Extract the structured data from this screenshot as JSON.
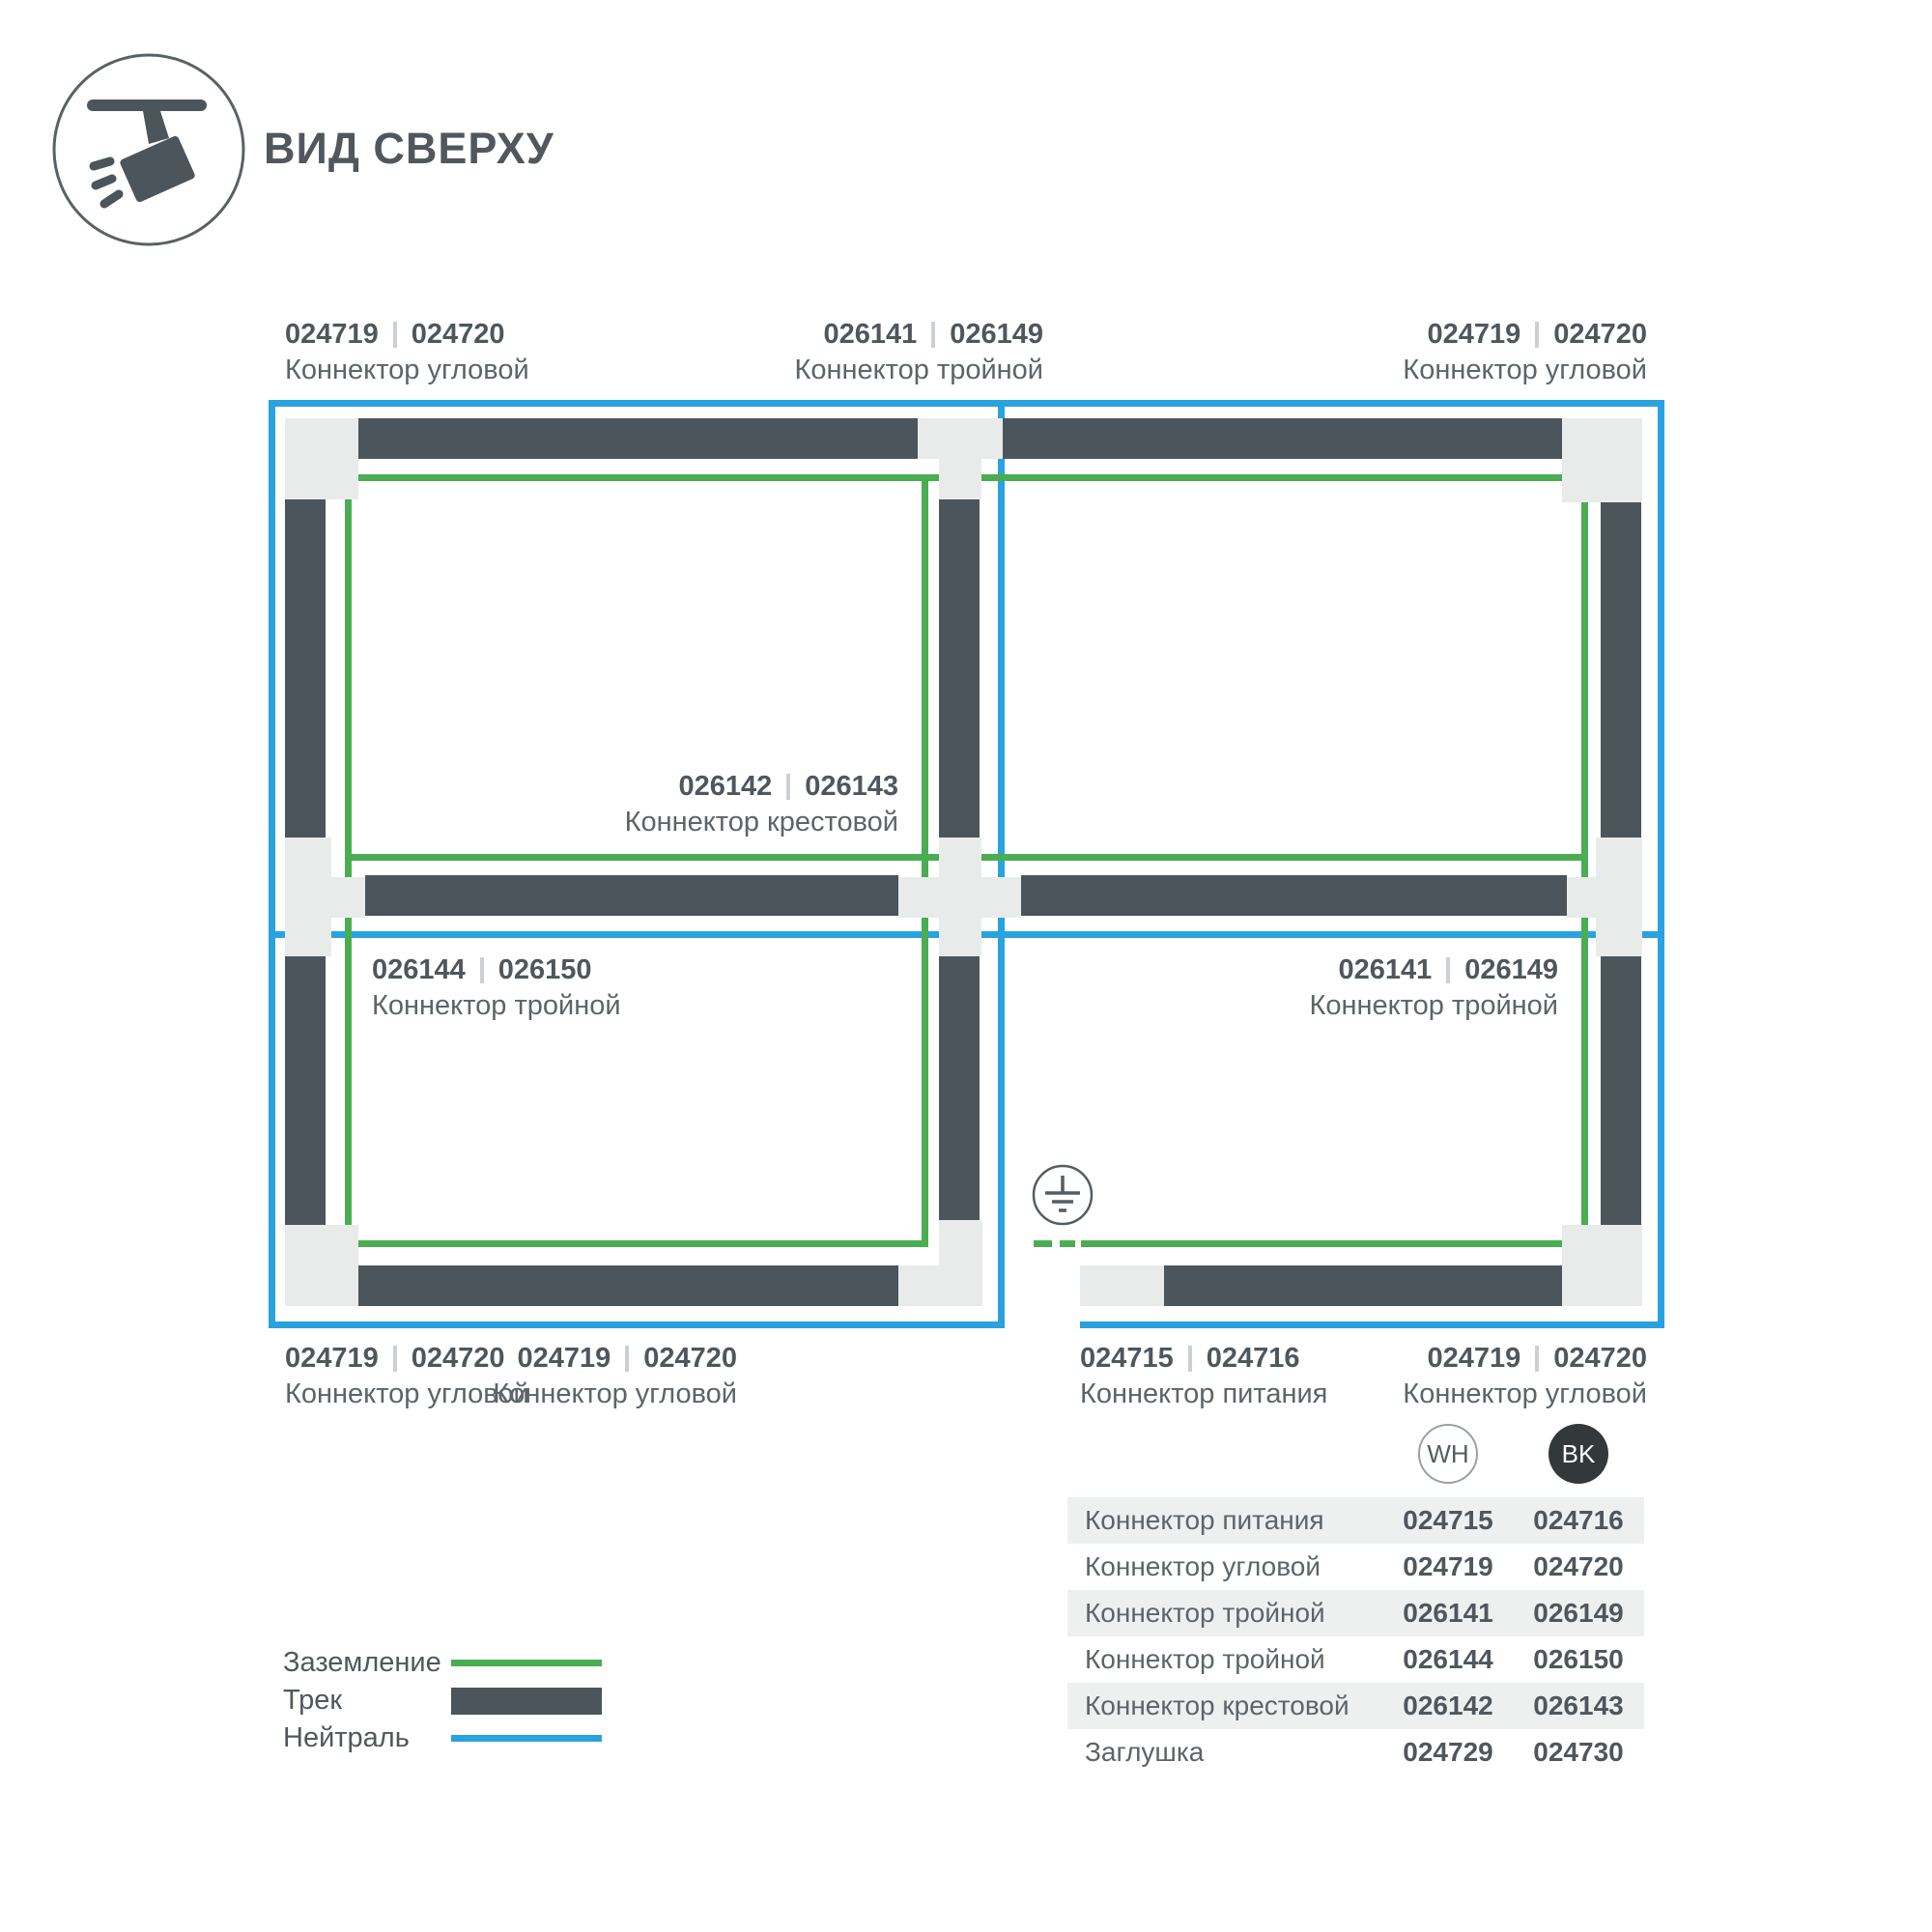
{
  "header": {
    "title": "ВИД СВЕРХУ"
  },
  "icon": {
    "name": "track-spotlight-icon"
  },
  "diagram": {
    "labels": {
      "top_left": {
        "wh": "024719",
        "bk": "024720",
        "name": "Коннектор угловой"
      },
      "top_center": {
        "wh": "026141",
        "bk": "026149",
        "name": "Коннектор тройной"
      },
      "top_right": {
        "wh": "024719",
        "bk": "024720",
        "name": "Коннектор угловой"
      },
      "center_cross": {
        "wh": "026142",
        "bk": "026143",
        "name": "Коннектор крестовой"
      },
      "mid_left": {
        "wh": "026144",
        "bk": "026150",
        "name": "Коннектор тройной"
      },
      "mid_right": {
        "wh": "026141",
        "bk": "026149",
        "name": "Коннектор тройной"
      },
      "bottom_left": {
        "wh": "024719",
        "bk": "024720",
        "name": "Коннектор угловой"
      },
      "bottom_middle": {
        "wh": "024719",
        "bk": "024720",
        "name": "Коннектор угловой"
      },
      "bottom_power": {
        "wh": "024715",
        "bk": "024716",
        "name": "Коннектор питания"
      },
      "bottom_right": {
        "wh": "024719",
        "bk": "024720",
        "name": "Коннектор угловой"
      }
    },
    "colors": {
      "ground_green": "#4bad51",
      "neutral_blue": "#29a2de",
      "track_dark": "#4c555b",
      "connector_gray": "#e9ebea"
    }
  },
  "variants": {
    "white": "WH",
    "black": "BK"
  },
  "table": {
    "rows": [
      {
        "name": "Коннектор питания",
        "wh": "024715",
        "bk": "024716"
      },
      {
        "name": "Коннектор угловой",
        "wh": "024719",
        "bk": "024720"
      },
      {
        "name": "Коннектор тройной",
        "wh": "026141",
        "bk": "026149"
      },
      {
        "name": "Коннектор тройной",
        "wh": "026144",
        "bk": "026150"
      },
      {
        "name": "Коннектор крестовой",
        "wh": "026142",
        "bk": "026143"
      },
      {
        "name": "Заглушка",
        "wh": "024729",
        "bk": "024730"
      }
    ]
  },
  "legend": {
    "ground": "Заземление",
    "track": "Трек",
    "neutral": "Нейтраль"
  }
}
